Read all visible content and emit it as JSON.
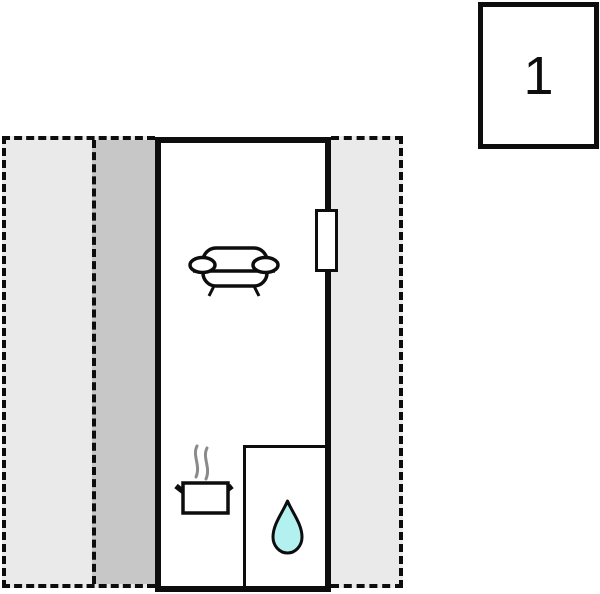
{
  "unit_label": "1",
  "colors": {
    "background": "#ffffff",
    "wall": "#0d0d0d",
    "zone_light": "#eaeaea",
    "zone_dark": "#c7c7c7",
    "room_fill": "#ffffff",
    "water_drop_fill": "#b3f1f1",
    "steam": "#8a8a8a"
  },
  "icons": [
    "sofa-icon",
    "cooking-pot-icon",
    "steam-icon",
    "water-drop-icon",
    "door-window-marker"
  ]
}
